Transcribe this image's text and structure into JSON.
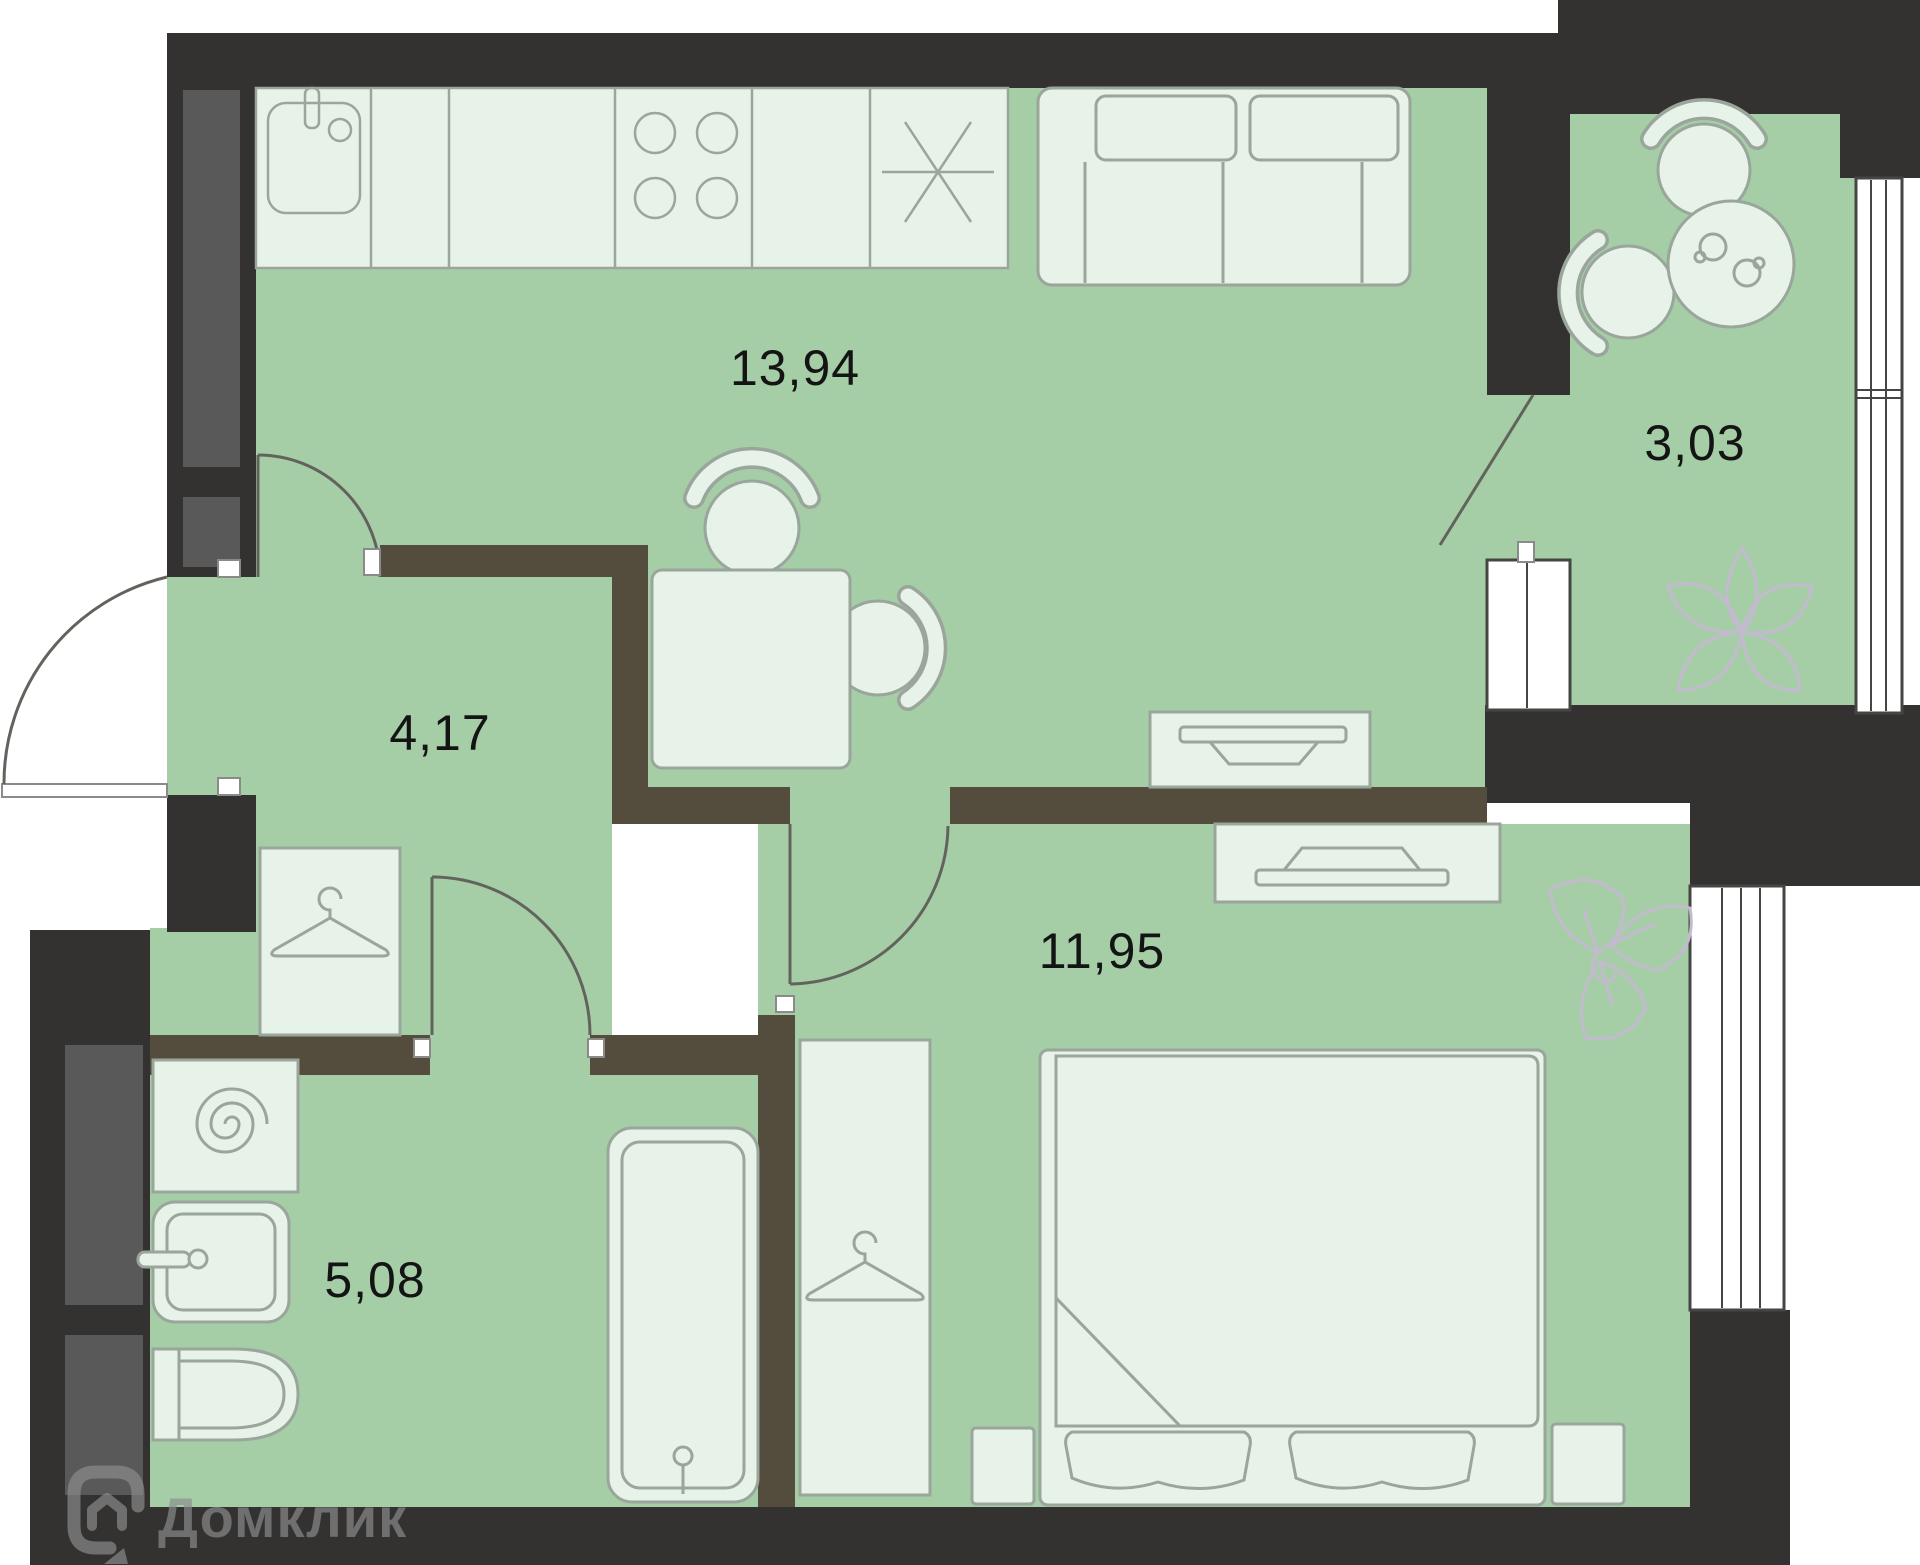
{
  "plan": {
    "watermark_brand": "Домклик",
    "rooms": [
      {
        "name": "kitchen-living-room",
        "area": "13,94"
      },
      {
        "name": "hallway",
        "area": "4,17"
      },
      {
        "name": "balcony",
        "area": "3,03"
      },
      {
        "name": "bedroom",
        "area": "11,95"
      },
      {
        "name": "bathroom",
        "area": "5,08"
      }
    ],
    "furniture": [
      "kitchen-sink",
      "kitchen-counter",
      "stove-burners",
      "worktop-cross",
      "sofa",
      "dining-table",
      "dining-chairs",
      "tv-stand-living",
      "tv-stand-bedroom",
      "wardrobe-hallway",
      "wardrobe-bedroom",
      "washing-machine",
      "bathroom-sink",
      "toilet",
      "bathtub",
      "bed",
      "pillows",
      "nightstands",
      "balcony-table",
      "balcony-chairs",
      "cups",
      "plants"
    ],
    "colors": {
      "background": "#ffffff",
      "exterior_wall": "#333231",
      "interior_wall": "#544d3e",
      "shaft_panel": "#595959",
      "floor": "#a5cea7",
      "furniture_fill": "#e7f2e8",
      "furniture_outline": "#9aa59b",
      "window_stroke": "#454543",
      "door_stroke": "#63635e",
      "label_text": "#141414",
      "plant_outline": "#c4bacf",
      "watermark": "#8d8d8d"
    }
  }
}
